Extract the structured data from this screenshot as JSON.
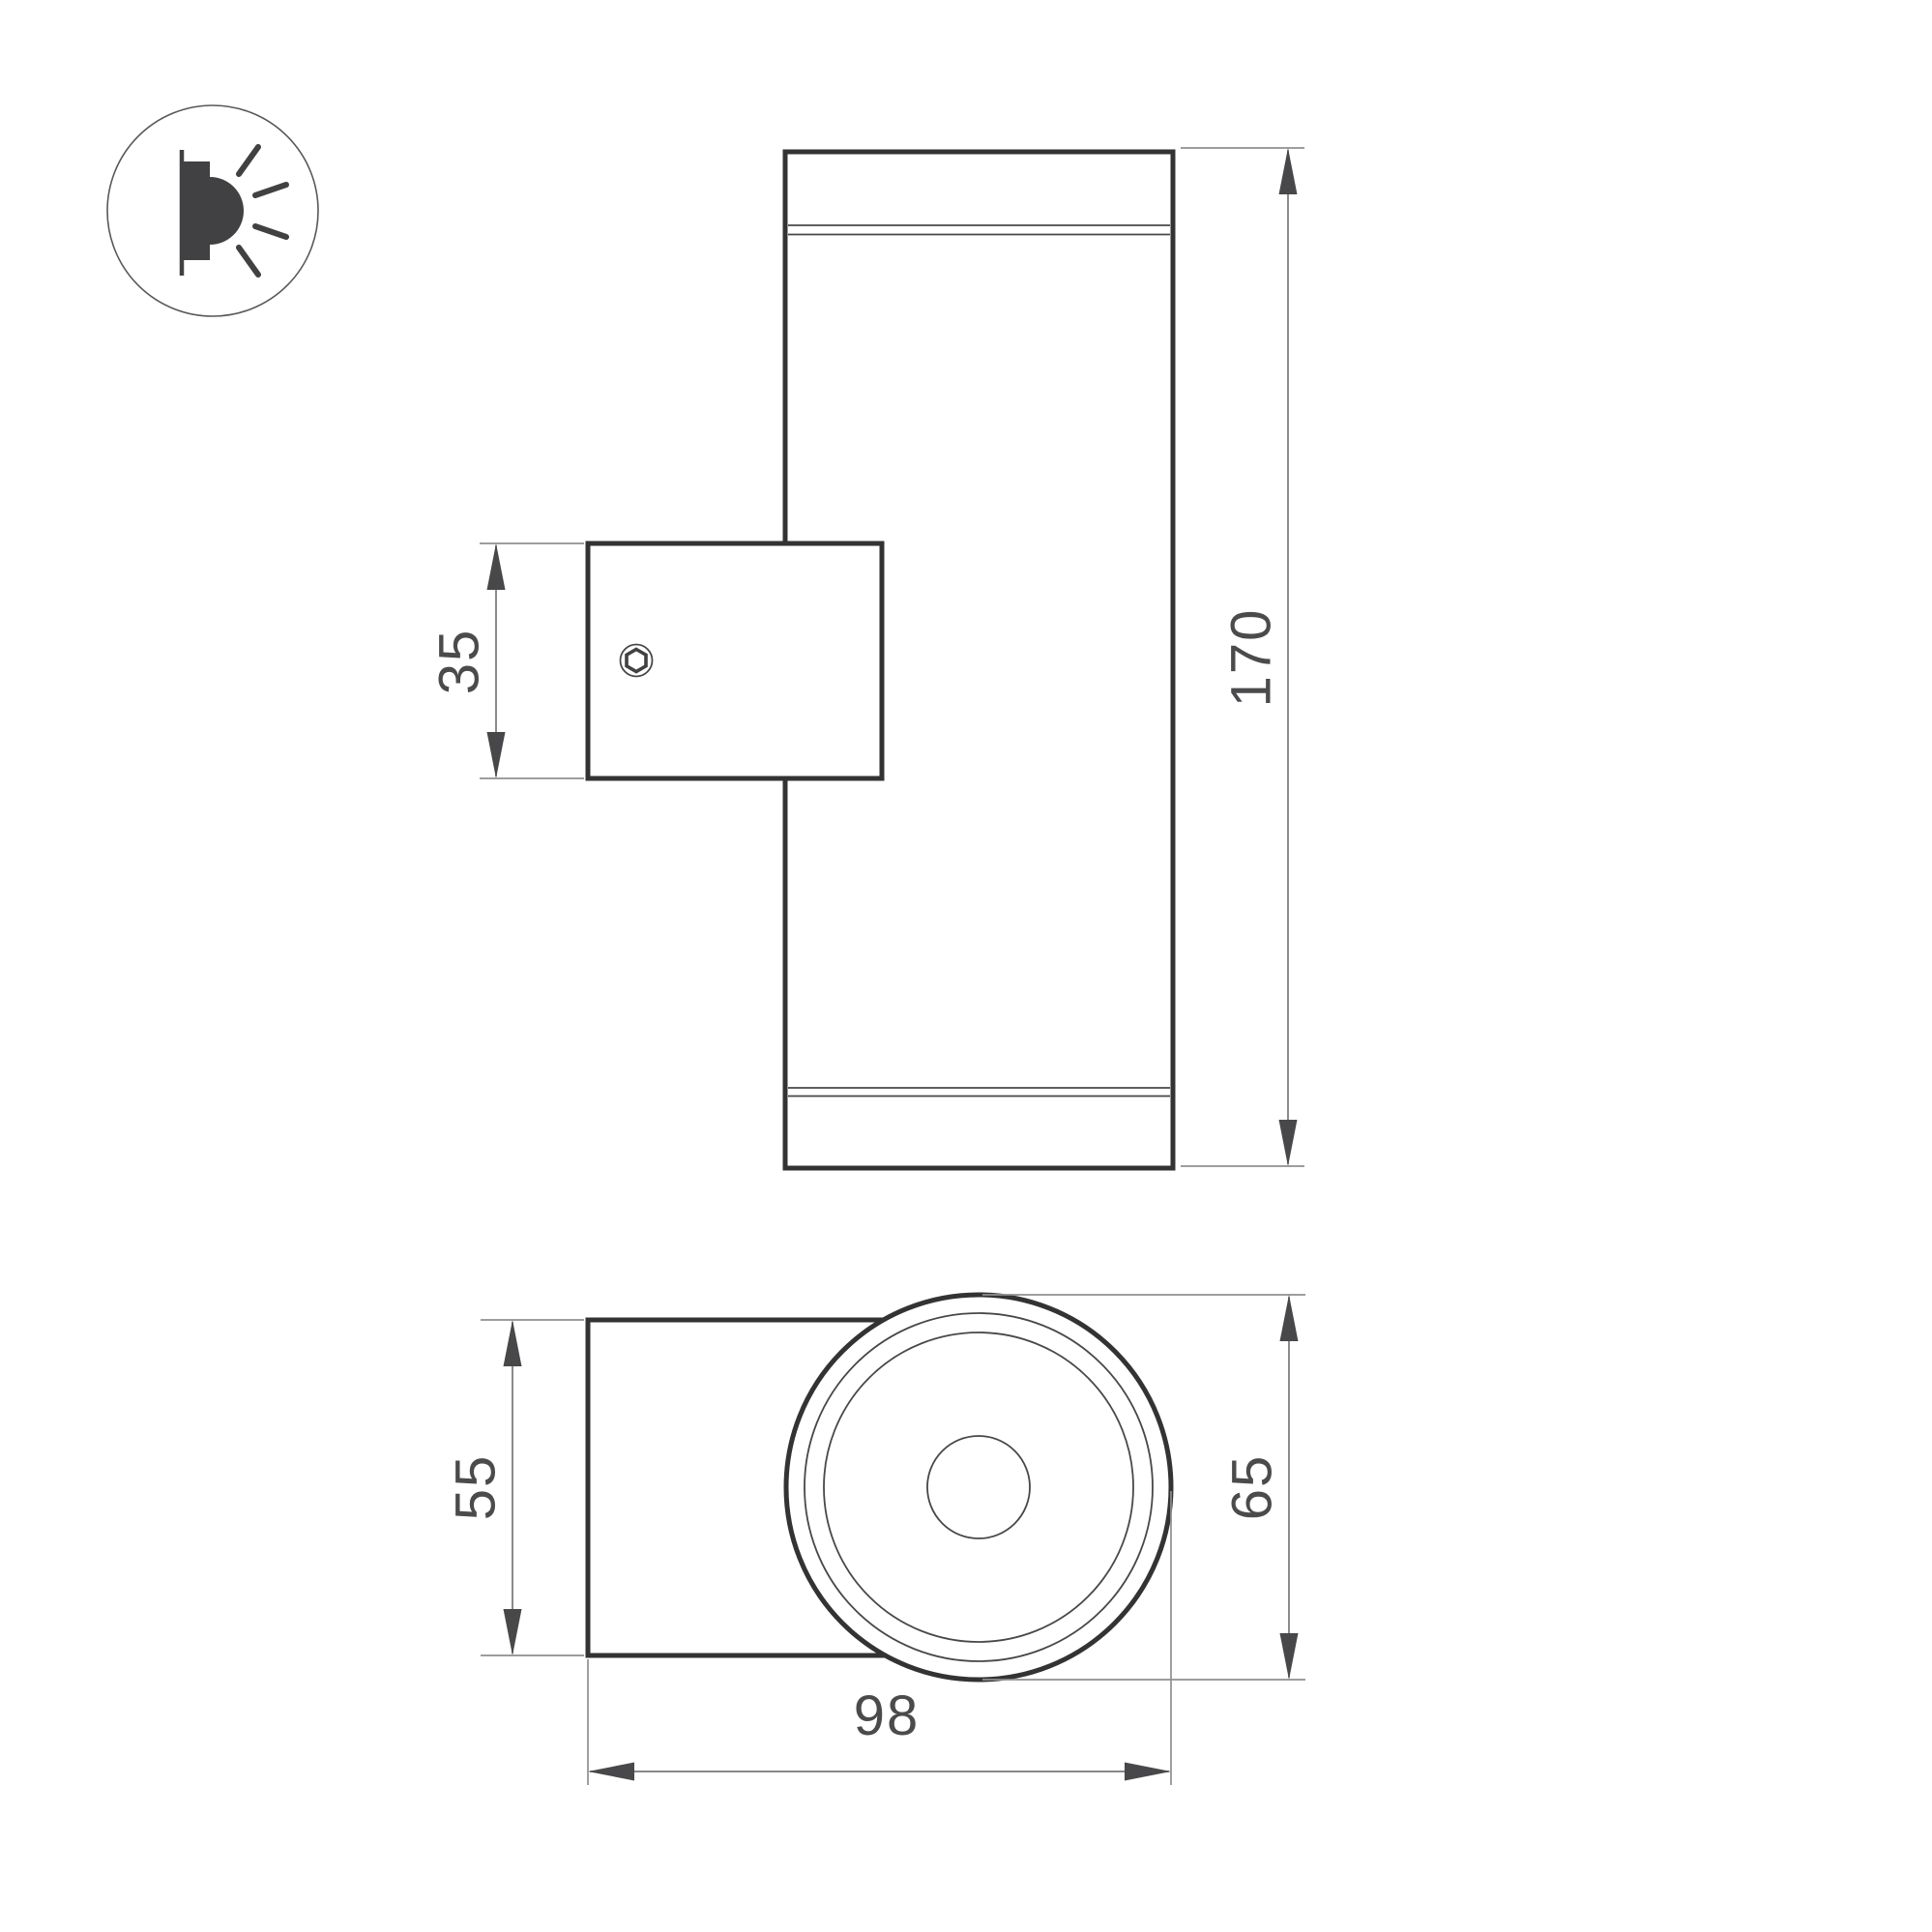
{
  "document": {
    "type": "technical-dimension-drawing",
    "subject": "cylindrical wall-mounted luminaire, two views"
  },
  "colors": {
    "background": "#ffffff",
    "outline": "#333335",
    "thin_line": "#48484a",
    "extension_line": "#8f8f91",
    "dim_line": "#77777a",
    "arrow": "#48484a",
    "text": "#4b4b4d",
    "icon_ink": "#414143",
    "icon_ring": "#58585a"
  },
  "icons": {
    "wall_light": "wall-light-side-emission-icon"
  },
  "front_view": {
    "bracket_height_label": "35",
    "body_height_label": "170"
  },
  "bottom_view": {
    "bracket_width_label": "55",
    "head_diameter_label": "65",
    "overall_depth_label": "98"
  }
}
